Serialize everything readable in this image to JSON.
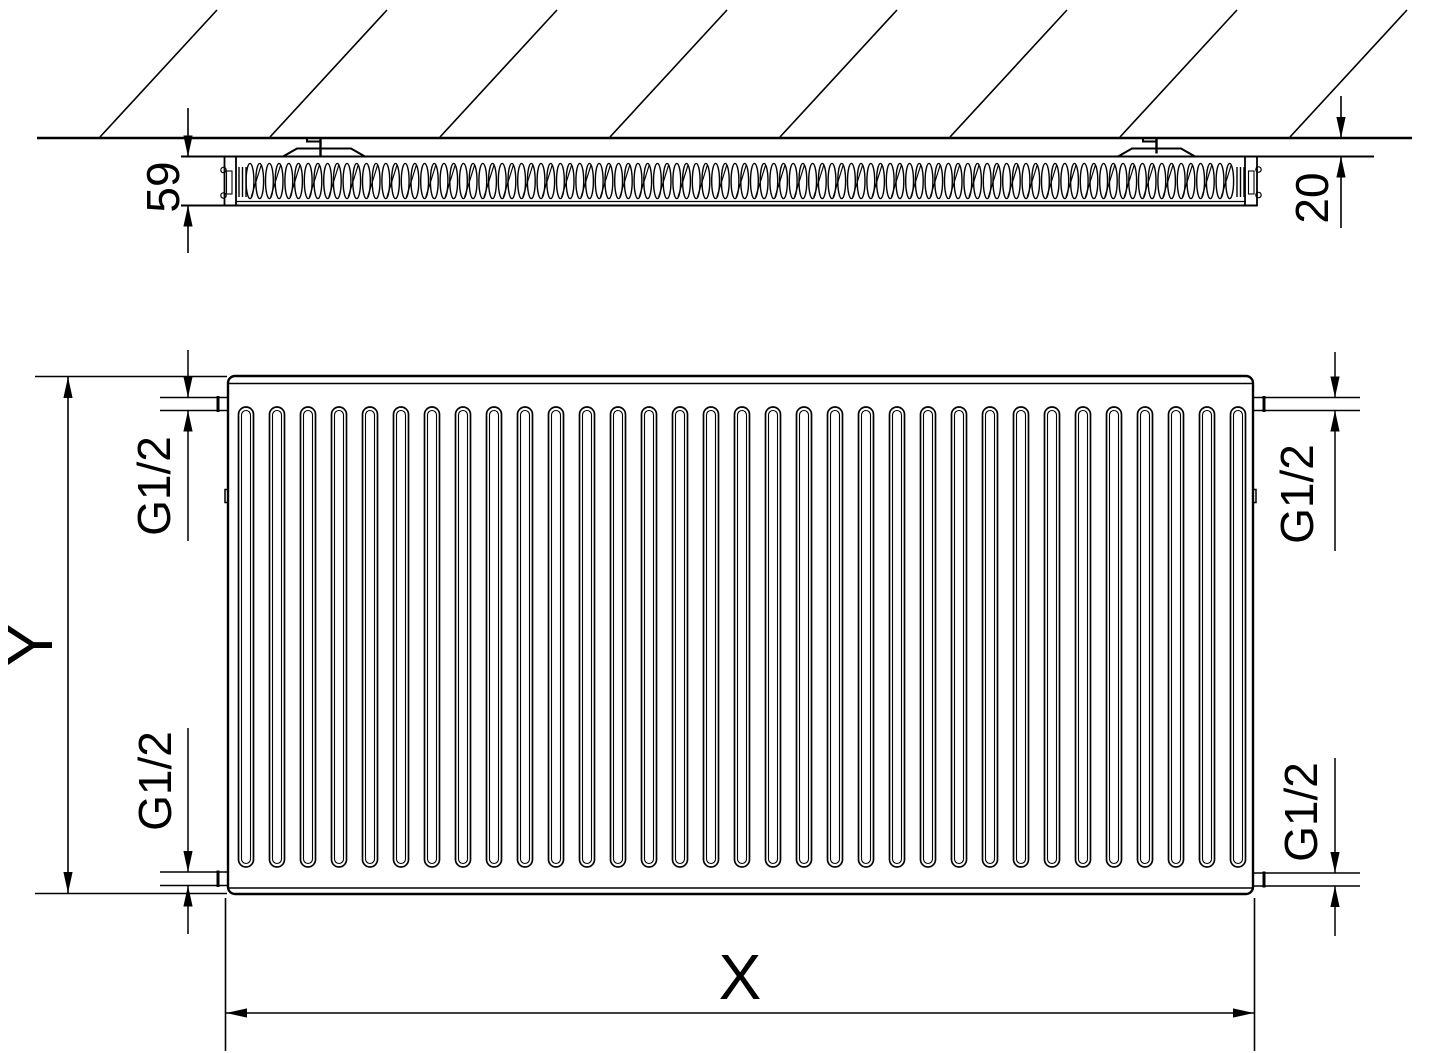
{
  "drawing": {
    "labels": {
      "depth": "59",
      "wall_clearance": "20",
      "height": "Y",
      "width": "X",
      "conn_top_left": "G1/2",
      "conn_top_right": "G1/2",
      "conn_bottom_left": "G1/2",
      "conn_bottom_right": "G1/2"
    },
    "views": {
      "top_section": {
        "depth_label": "59",
        "wall_clearance_label": "20",
        "wall_bracket_count": 2
      },
      "front": {
        "width_label": "X",
        "height_label": "Y",
        "channel_count": 33,
        "connection_labels": [
          "G1/2",
          "G1/2",
          "G1/2",
          "G1/2"
        ]
      }
    },
    "colors": {
      "line": "#000000",
      "background": "#ffffff"
    }
  }
}
